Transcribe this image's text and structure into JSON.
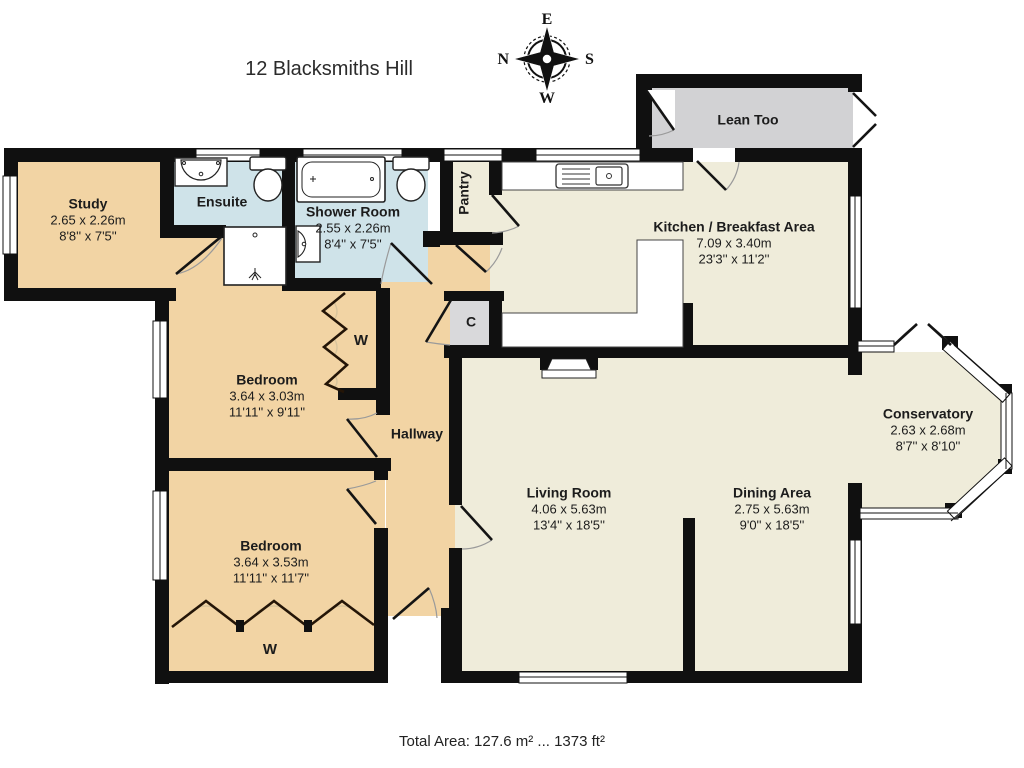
{
  "title": "12 Blacksmiths Hill",
  "compass": {
    "north": "N",
    "east": "E",
    "south": "S",
    "west": "W"
  },
  "footer": {
    "total_area": "Total Area: 127.6 m² ... 1373 ft²"
  },
  "colors": {
    "bedroom_tan": "#f2d4a4",
    "bathroom_blue": "#cfe3e9",
    "living_cream": "#efecda",
    "lean_too_gray": "#d2d2d4",
    "cupboard_gray": "#d9d9db",
    "wall_black": "#101010"
  },
  "rooms": {
    "study": {
      "name": "Study",
      "metric": "2.65 x 2.26m",
      "imperial": "8'8'' x 7'5''"
    },
    "ensuite": {
      "name": "Ensuite"
    },
    "shower_room": {
      "name": "Shower Room",
      "metric": "2.55 x 2.26m",
      "imperial": "8'4'' x 7'5''"
    },
    "pantry": {
      "name": "Pantry"
    },
    "kitchen": {
      "name": "Kitchen / Breakfast Area",
      "metric": "7.09 x 3.40m",
      "imperial": "23'3'' x 11'2''"
    },
    "lean_too": {
      "name": "Lean Too"
    },
    "bedroom1": {
      "name": "Bedroom",
      "metric": "3.64 x 3.03m",
      "imperial": "11'11'' x 9'11''"
    },
    "bedroom2": {
      "name": "Bedroom",
      "metric": "3.64 x 3.53m",
      "imperial": "11'11'' x 11'7''"
    },
    "hallway": {
      "name": "Hallway"
    },
    "living_room": {
      "name": "Living Room",
      "metric": "4.06 x 5.63m",
      "imperial": "13'4'' x 18'5''"
    },
    "dining_area": {
      "name": "Dining Area",
      "metric": "2.75 x 5.63m",
      "imperial": "9'0'' x 18'5''"
    },
    "conservatory": {
      "name": "Conservatory",
      "metric": "2.63 x 2.68m",
      "imperial": "8'7'' x 8'10''"
    },
    "wardrobe1": {
      "label": "W"
    },
    "wardrobe2": {
      "label": "W"
    },
    "cupboard": {
      "label": "C"
    }
  }
}
